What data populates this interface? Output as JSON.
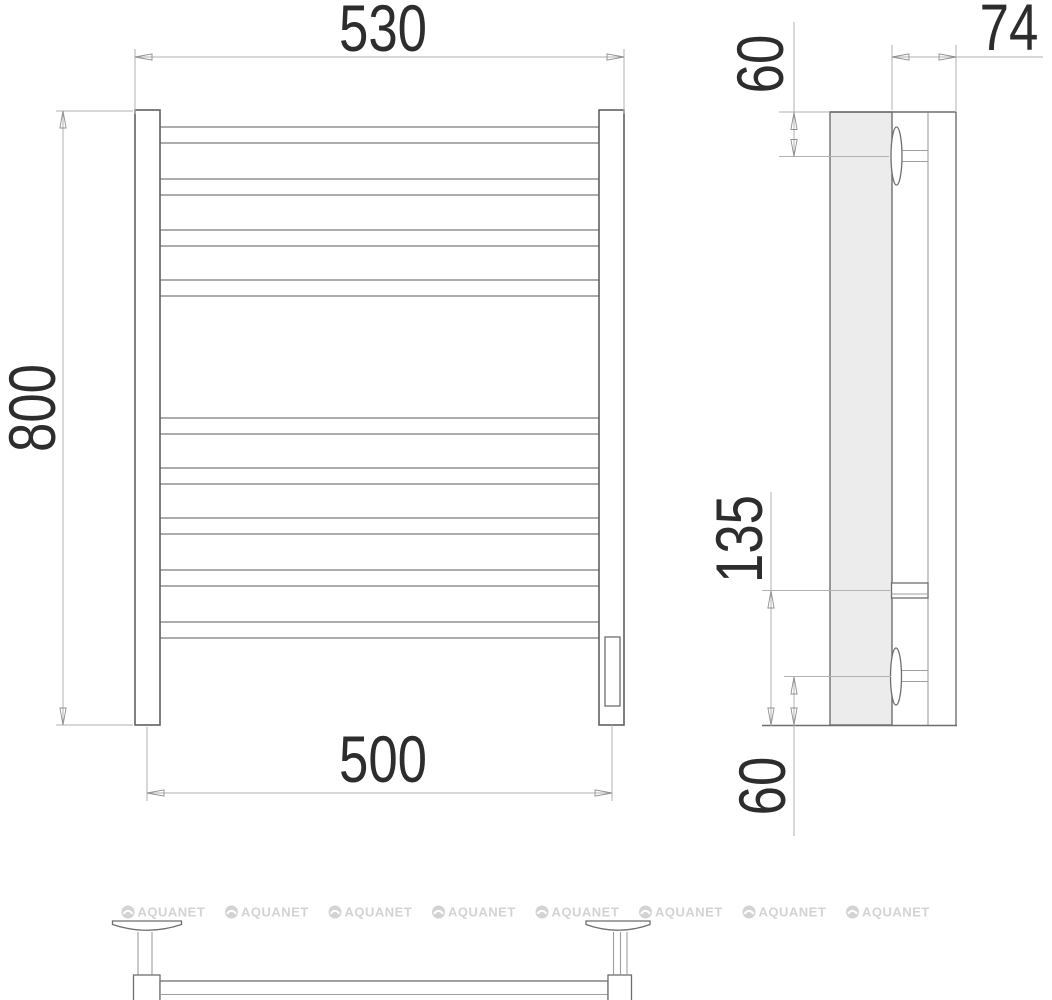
{
  "dimensions": {
    "front": {
      "width_top_mm": "530",
      "height_mm": "800",
      "width_bottom_mm": "500"
    },
    "side": {
      "depth_mm": "74",
      "top_bracket_offset_mm": "60",
      "bracket_span_mm": "135",
      "bottom_bracket_offset_mm": "60"
    }
  },
  "watermark": {
    "label": "AQUANET",
    "count": 8
  },
  "colors": {
    "line-main": "#6e6e6e",
    "line-light": "#9e9e9e",
    "dim-line": "#b2b2b2",
    "dim-text": "#2d2d2d",
    "fill-tube-side": "#ececec",
    "watermark": "#d3d3d3"
  }
}
